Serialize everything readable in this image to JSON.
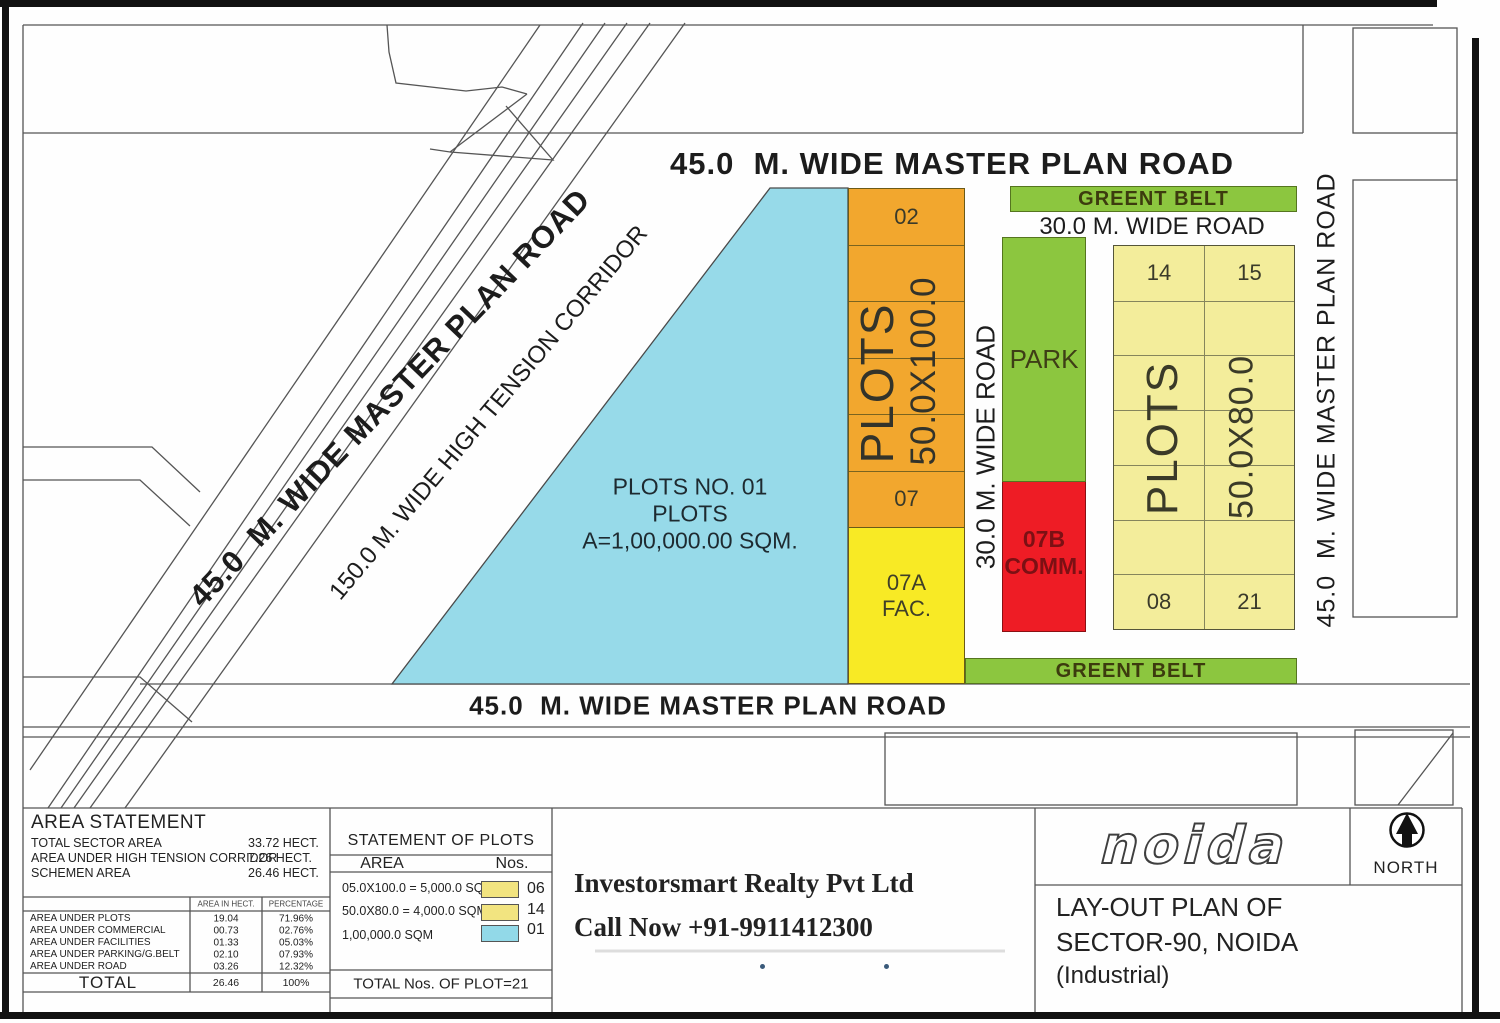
{
  "map": {
    "road_top": "45.0  M. WIDE MASTER PLAN ROAD",
    "road_bottom": "45.0  M. WIDE MASTER PLAN ROAD",
    "road_right": "45.0  M. WIDE MASTER PLAN ROAD",
    "road_diagonal": "45.0  M. WIDE MASTER PLAN ROAD",
    "high_tension_corridor": "150.0 M. WIDE HIGH TENSION CORRIDOR",
    "road_30m_vertical": "30.0 M. WIDE ROAD",
    "road_30m_horizontal": "30.0 M. WIDE ROAD",
    "green_belt_top": "GREENT BELT",
    "green_belt_bottom": "GREENT BELT",
    "park_label": "PARK",
    "commercial_plot": {
      "number": "07B",
      "type": "COMM."
    },
    "facility_plot": {
      "number": "07A",
      "type": "FAC."
    },
    "plot_01": {
      "line1": "PLOTS NO. 01",
      "line2": "PLOTS",
      "line3": "A=1,00,000.00 SQM."
    },
    "strip_50x100": {
      "first_plot": "02",
      "last_plot": "07",
      "plots_label": "PLOTS",
      "size_label": "50.0X100.0"
    },
    "grid_50x80": {
      "plots_label": "PLOTS",
      "size_label": "50.0X80.0",
      "top_left": "14",
      "top_right": "15",
      "bottom_left": "08",
      "bottom_right": "21"
    }
  },
  "title_block": {
    "area_statement": {
      "title": "AREA STATEMENT",
      "summary": [
        {
          "label": "TOTAL SECTOR AREA",
          "value": "33.72 HECT."
        },
        {
          "label": "AREA UNDER HIGH TENSION CORRIDOR",
          "value": "7.26 HECT."
        },
        {
          "label": "SCHEMEN AREA",
          "value": "26.46 HECT."
        }
      ],
      "col_headers": [
        "AREA IN HECT.",
        "PERCENTAGE"
      ],
      "rows": [
        {
          "label": "AREA UNDER PLOTS",
          "hect": "19.04",
          "pct": "71.96%"
        },
        {
          "label": "AREA UNDER COMMERCIAL",
          "hect": "00.73",
          "pct": "02.76%"
        },
        {
          "label": "AREA UNDER FACILITIES",
          "hect": "01.33",
          "pct": "05.03%"
        },
        {
          "label": "AREA UNDER PARKING/G.BELT",
          "hect": "02.10",
          "pct": "07.93%"
        },
        {
          "label": "AREA UNDER ROAD",
          "hect": "03.26",
          "pct": "12.32%"
        }
      ],
      "total": {
        "label": "TOTAL",
        "hect": "26.46",
        "pct": "100%"
      }
    },
    "statement_of_plots": {
      "title": "STATEMENT OF PLOTS",
      "col_area": "AREA",
      "col_nos": "Nos.",
      "rows": [
        {
          "area": "05.0X100.0 = 5,000.0 SQM.",
          "swatch_color": "#F2E480",
          "nos": "06"
        },
        {
          "area": "50.0X80.0 = 4,000.0 SQM.",
          "swatch_color": "#F2E480",
          "nos": "14"
        },
        {
          "area": "1,00,000.0 SQM",
          "swatch_color": "#92D9E8",
          "nos": "01"
        }
      ],
      "total": "TOTAL Nos. OF PLOT=21"
    },
    "promo": {
      "line1": "Investorsmart Realty Pvt Ltd",
      "line2": "Call Now +91-9911412300"
    },
    "noida_logo": "noida",
    "north_label": "NORTH",
    "plan_title": {
      "line1": "LAY-OUT PLAN OF",
      "line2": "SECTOR-90, NOIDA",
      "line3": "(Industrial)"
    }
  },
  "colors": {
    "plot_orange": "#F2A72E",
    "plot_yellow_bright": "#F8EA25",
    "plot_yellow_pale": "#F3ED9B",
    "green_belt": "#8CC63F",
    "commercial_red": "#EE1C25",
    "plot01_cyan": "#97DAE9"
  }
}
